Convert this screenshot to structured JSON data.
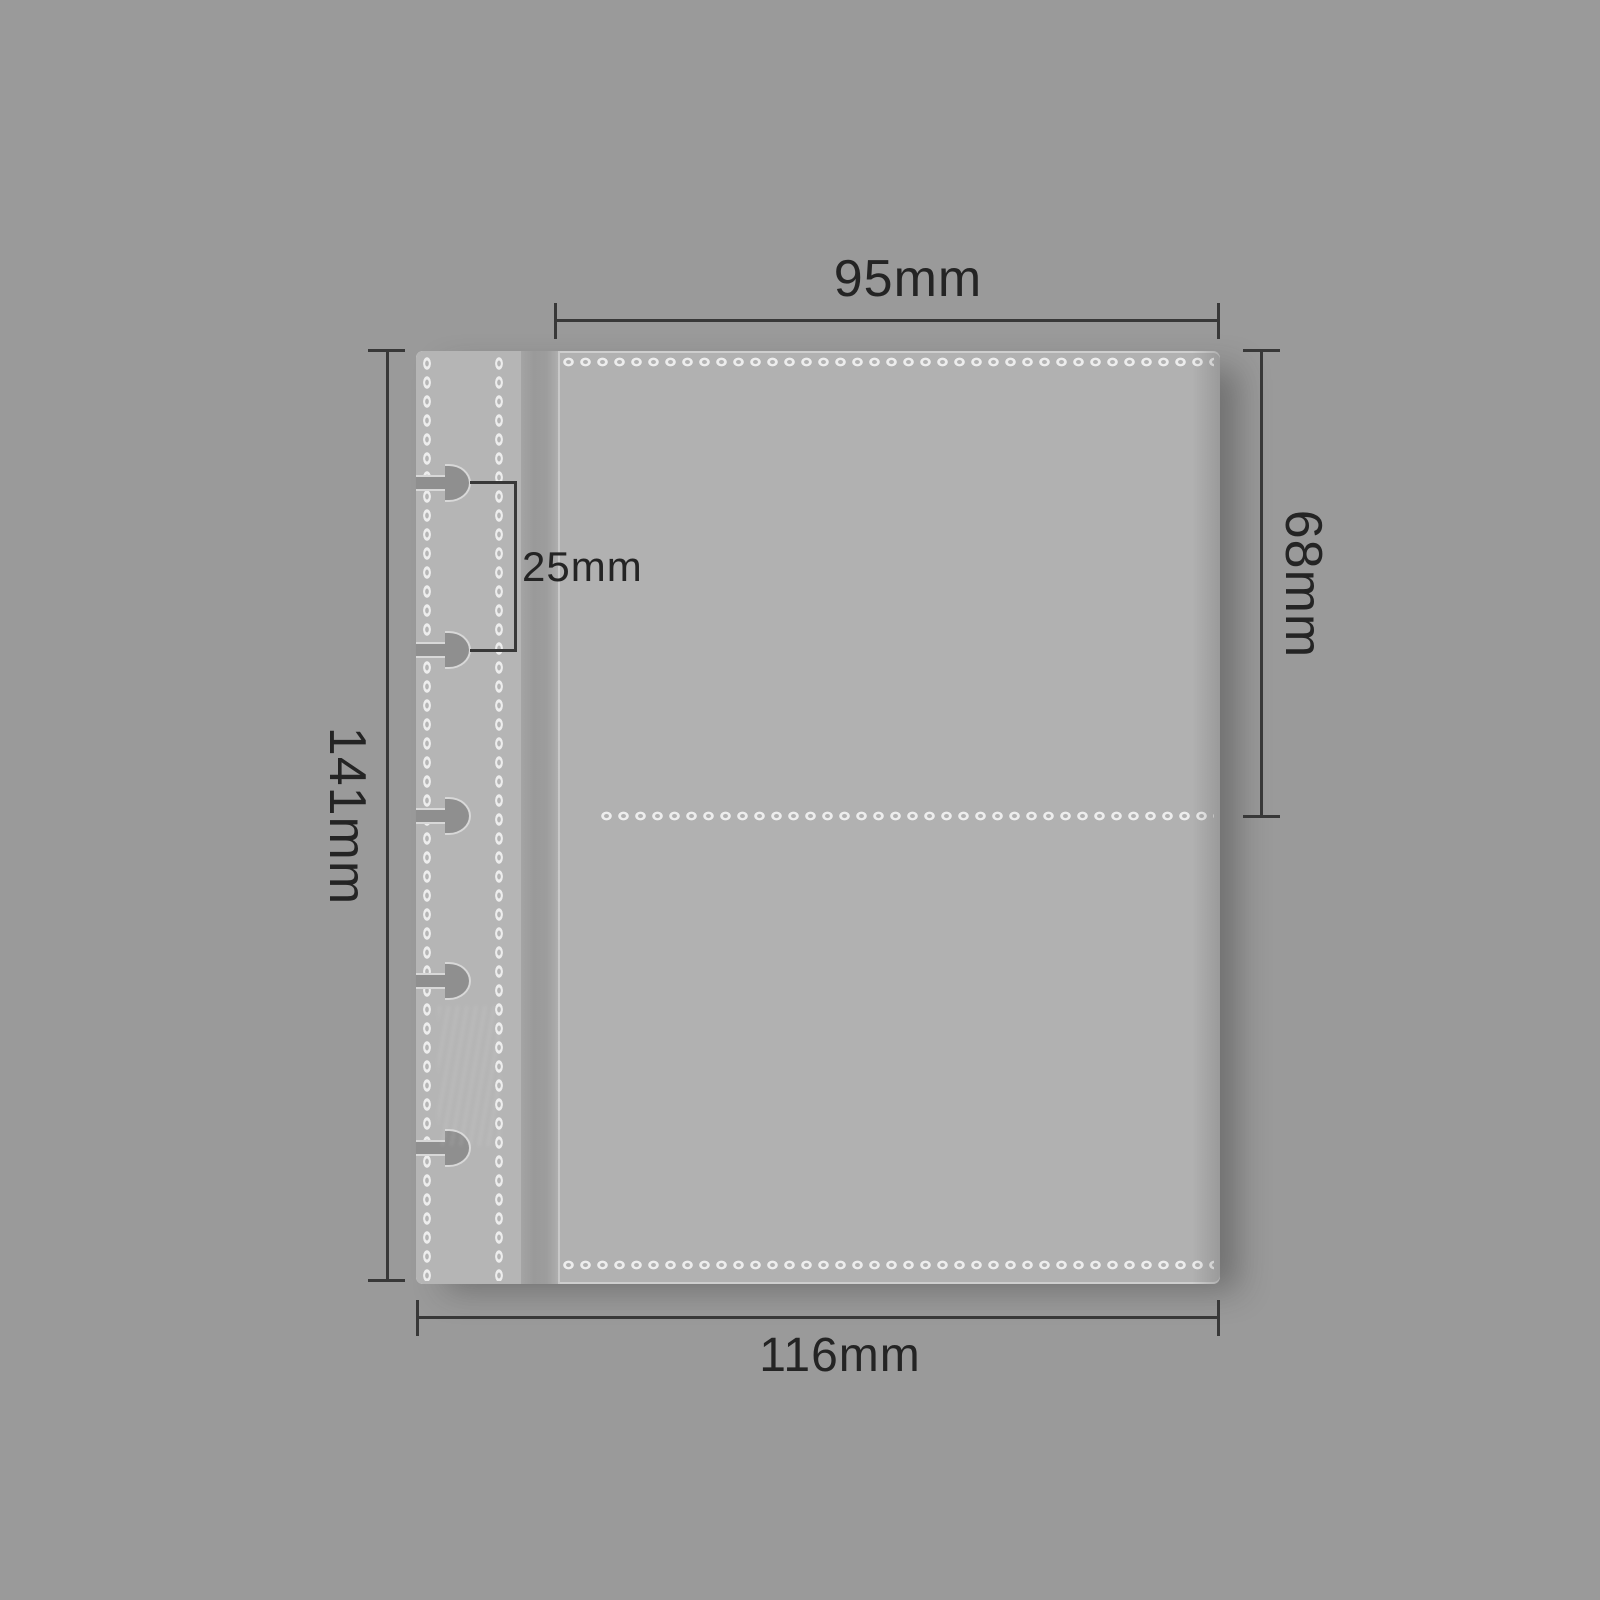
{
  "diagram": {
    "description": "dimension diagram of a transparent binder pocket refill page",
    "hole_count": 5,
    "labels": {
      "top_width": "95mm",
      "right_height": "68mm",
      "left_height": "141mm",
      "bottom_width": "116mm",
      "hole_spacing": "25mm"
    },
    "colors": {
      "background": "#9a9a9a",
      "sleeve": "#b1b1b1",
      "binding_strip": "#b5b5b5",
      "stitch_dots": "#ededed",
      "hole_fill": "#8f8f8f",
      "hole_outline": "#d8d8d8",
      "dimension_lines": "#383838",
      "label_text": "#242424"
    }
  }
}
